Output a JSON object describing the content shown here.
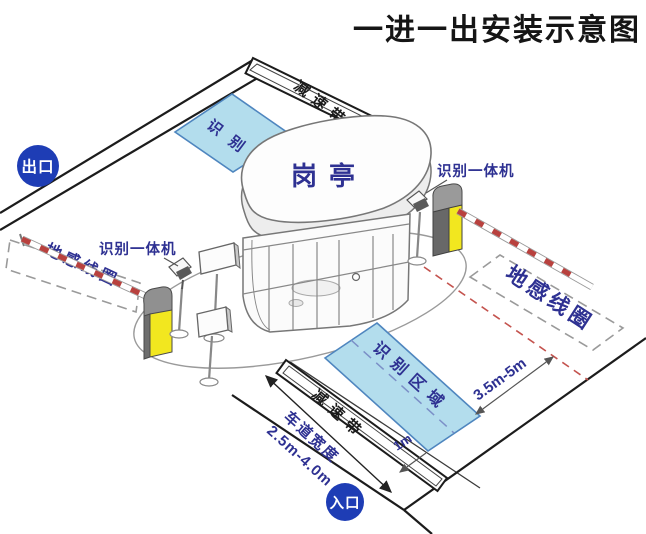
{
  "title": "一进一出安装示意图",
  "badges": {
    "exit": "出口",
    "entry": "入口"
  },
  "booth": {
    "label": "岗亭"
  },
  "areas": {
    "recognition_top": "识别区域",
    "recognition_bottom": "识别区域"
  },
  "speed_bumps": {
    "top": "减速带",
    "bottom": "减速带"
  },
  "coils": {
    "left": "地感线圈",
    "right": "地感线圈"
  },
  "devices": {
    "reader_left": "识别一体机",
    "reader_right": "识别一体机"
  },
  "measurements": {
    "barrier_to_area": "3.5m-5m",
    "area_to_bump": "1m",
    "lane_width_title": "车道宽度",
    "lane_width_range": "2.5m-4.0m"
  },
  "colors": {
    "badge_blue": "#1e3db5",
    "area_blue": "#b3dded",
    "area_stroke": "#4f86bf",
    "label_blue": "#2e3192",
    "machine_yellow": "#f2e71f",
    "stop_red": "#c4534e",
    "arm_red": "#b8413e",
    "line_black": "#1c1c1c"
  }
}
